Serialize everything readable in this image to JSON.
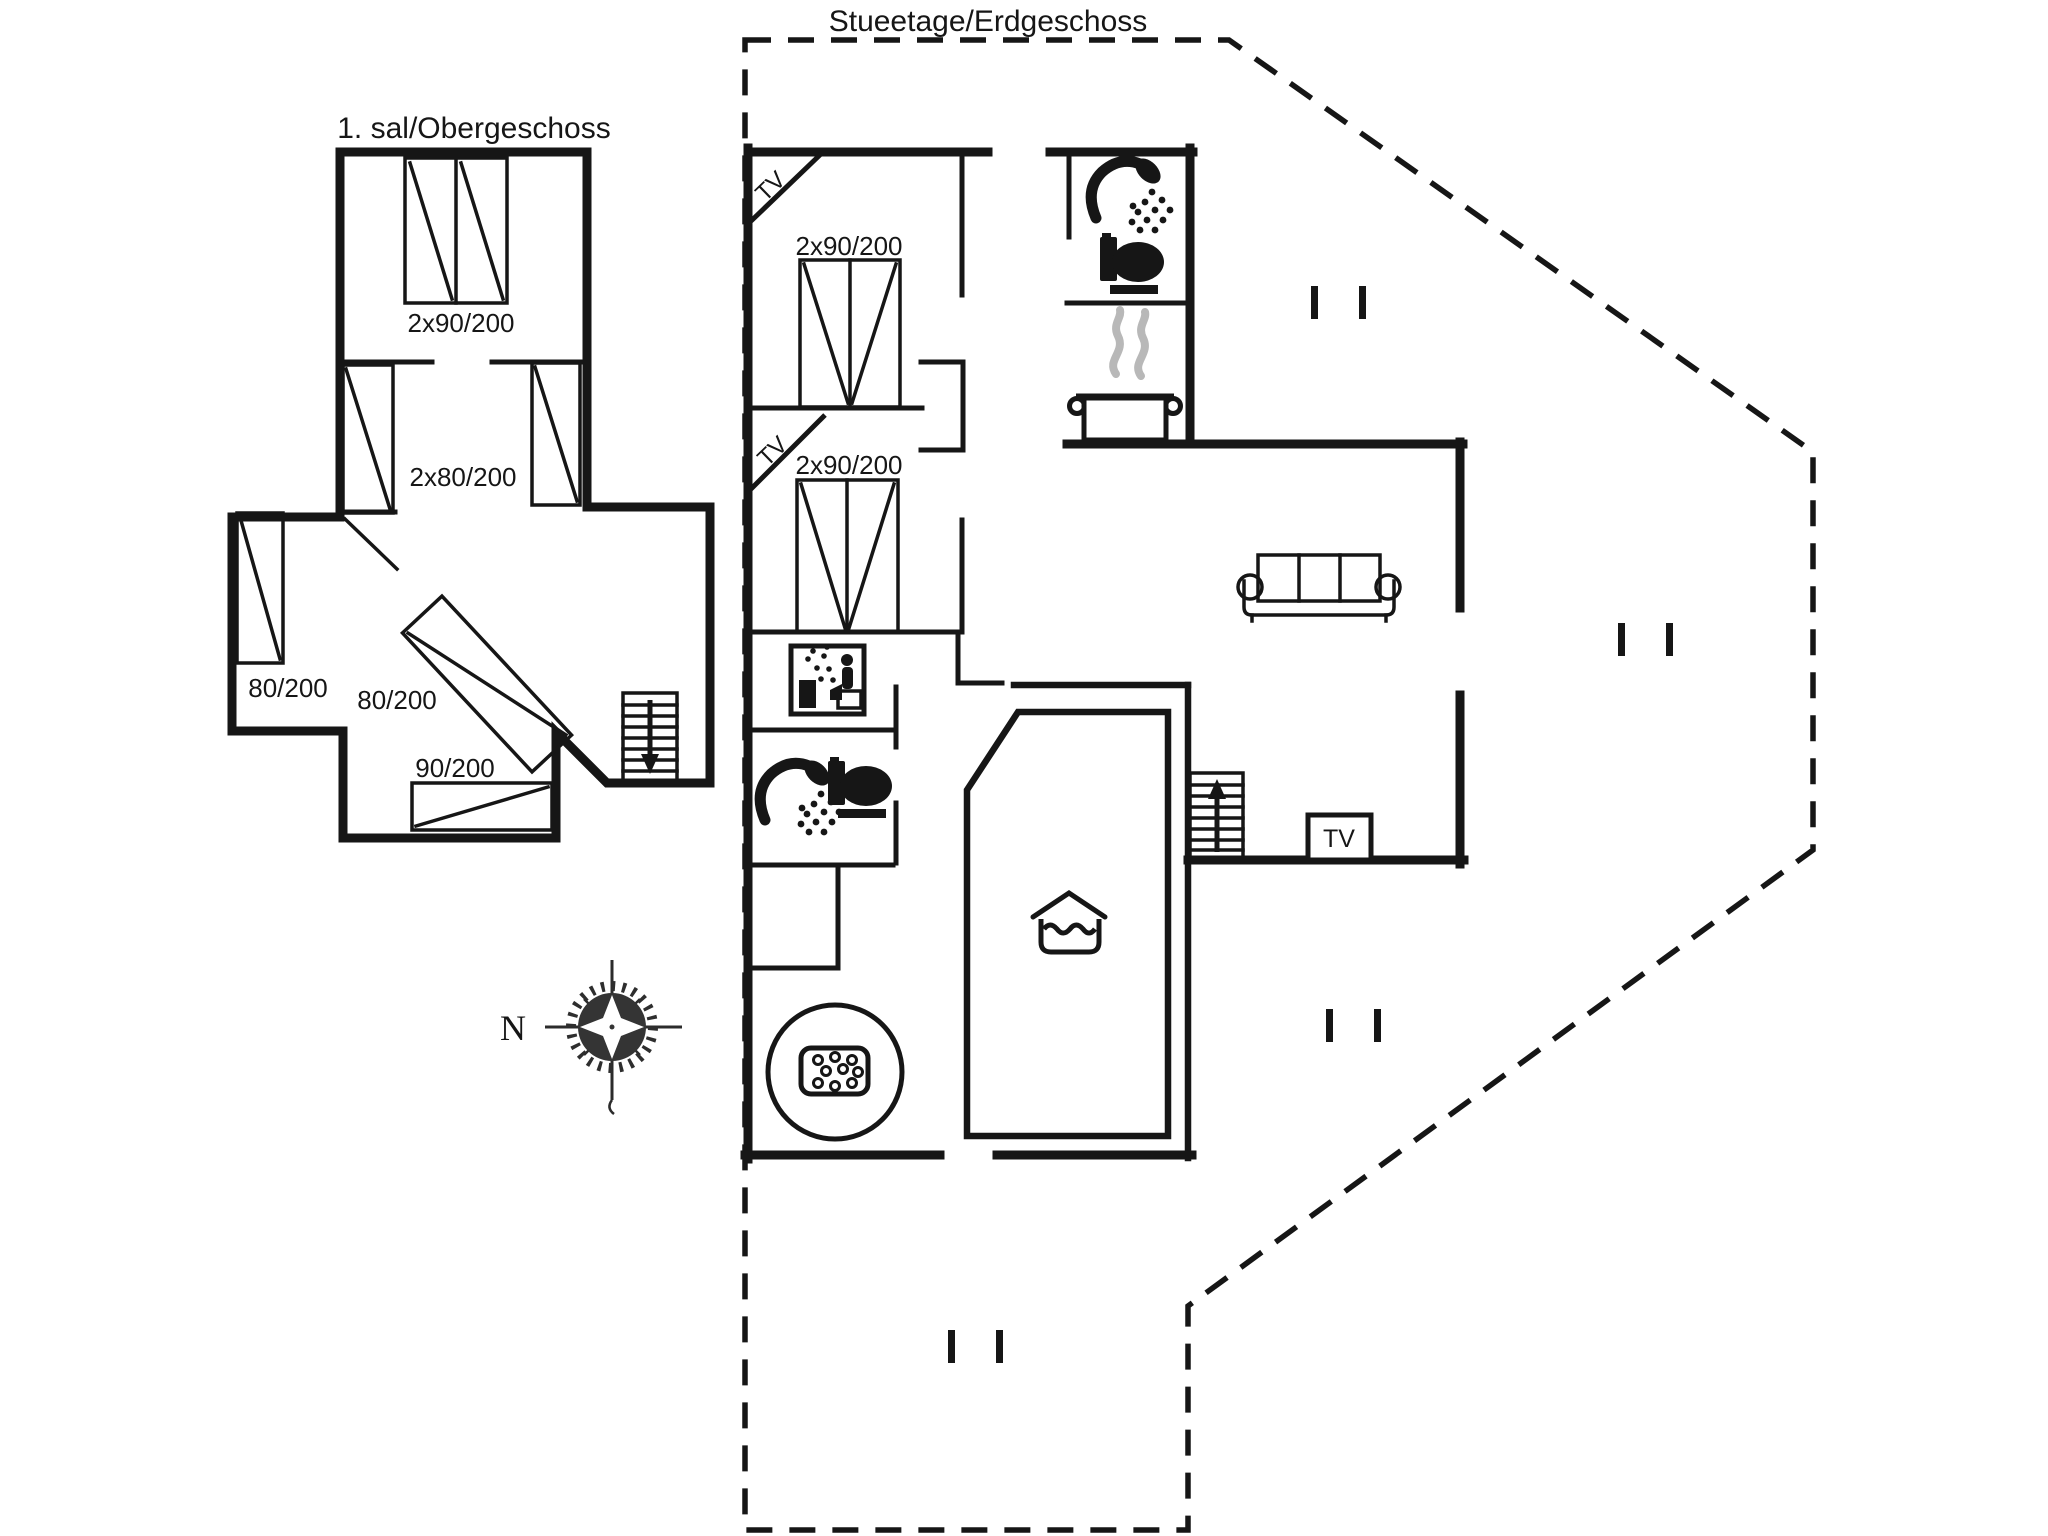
{
  "upper_floor": {
    "title": "1. sal/Obergeschoss",
    "bed_labels": {
      "double": "2x90/200",
      "twin": "2x80/200",
      "single_left": "80/200",
      "single_middle": "80/200",
      "single_bottom": "90/200"
    },
    "icons": [
      "bed-icon",
      "stairs-down-icon",
      "door-swing-icon"
    ]
  },
  "ground_floor": {
    "title": "Stueetage/Erdgeschoss",
    "bed_labels": {
      "bedroom1": "2x90/200",
      "bedroom2": "2x90/200"
    },
    "tv_corner_labels": {
      "bedroom1": "TV",
      "bedroom2": "TV"
    },
    "tv_unit_label": "TV",
    "icons": [
      "shower-icon",
      "toilet-icon",
      "stove-pot-icon",
      "steam-icon",
      "sauna-icon",
      "sofa-icon",
      "stairs-up-icon",
      "tv-unit",
      "pool-icon",
      "whirlpool-icon",
      "door-marker",
      "bed-icon"
    ]
  },
  "compass": {
    "north_label": "N"
  },
  "colors": {
    "ink": "#161616",
    "steam": "#b8b8b8",
    "background": "#ffffff"
  }
}
